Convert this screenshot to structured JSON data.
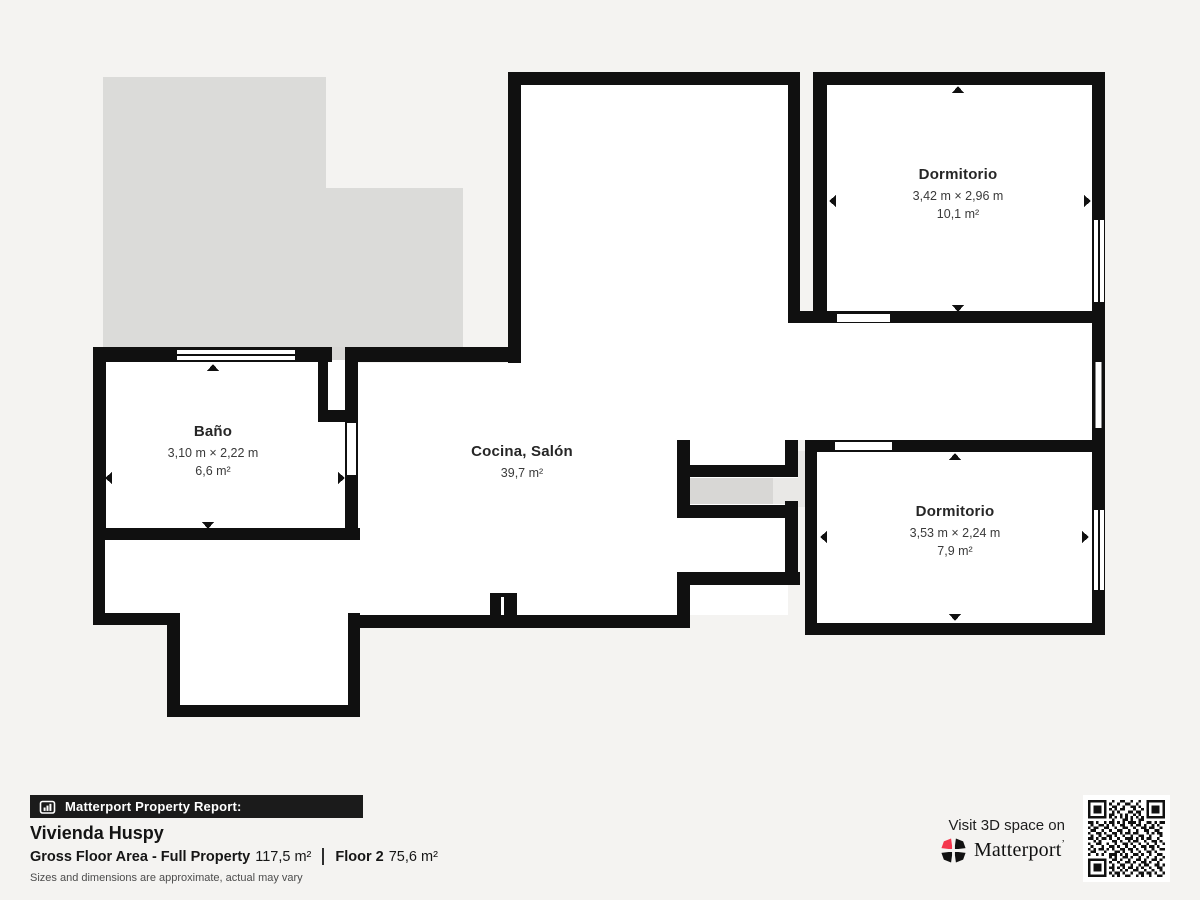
{
  "plan": {
    "rooms": [
      {
        "id": "bano",
        "name": "Baño",
        "dimensions": "3,10 m × 2,22 m",
        "area": "6,6 m²"
      },
      {
        "id": "cocina_salon",
        "name": "Cocina, Salón",
        "dimensions": "",
        "area": "39,7 m²"
      },
      {
        "id": "dormitorio_1",
        "name": "Dormitorio",
        "dimensions": "3,42 m × 2,96 m",
        "area": "10,1 m²"
      },
      {
        "id": "dormitorio_2",
        "name": "Dormitorio",
        "dimensions": "3,53 m × 2,24 m",
        "area": "7,9 m²"
      }
    ],
    "colors": {
      "wall": "#101010",
      "room_fill": "#ffffff",
      "terrace_fill": "#dbdbd9",
      "threshold_gray": "#d8d7d5",
      "threshold_light": "#e9e8e6",
      "background": "#f4f3f1"
    }
  },
  "footer": {
    "report_label": "Matterport Property Report:",
    "property_name": "Vivienda Huspy",
    "gross_floor_area_label": "Gross Floor Area - Full Property",
    "gross_floor_area_value": "117,5 m²",
    "floor_label": "Floor 2",
    "floor_value": "75,6 m²",
    "disclaimer": "Sizes and dimensions are approximate, actual may vary",
    "cta_text": "Visit 3D space on",
    "brand_name": "Matterport",
    "brand_mark": "’",
    "brand_color": "#f4364c"
  }
}
